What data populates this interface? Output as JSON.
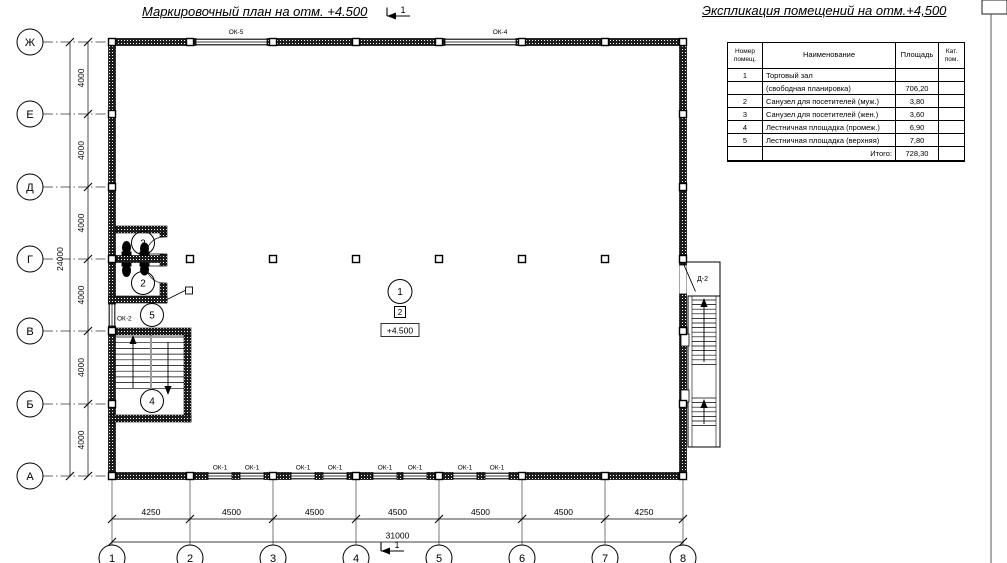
{
  "titles": {
    "plan": "Маркировочный план на отм. +4.500",
    "explication": "Экспликация помещений на отм.+4,500"
  },
  "section_mark": {
    "top": "1",
    "bottom": "1"
  },
  "table": {
    "headers": {
      "num": "Номер помещ.",
      "name": "Наименование",
      "area": "Площадь",
      "cat": "Кат. пом."
    },
    "rows": [
      {
        "num": "1",
        "name": "Торговый зал",
        "area": "",
        "cat": ""
      },
      {
        "num": "",
        "name": "(свободная планировка)",
        "area": "706,20",
        "cat": ""
      },
      {
        "num": "2",
        "name": "Санузел для посетителей (муж.)",
        "area": "3,80",
        "cat": ""
      },
      {
        "num": "3",
        "name": "Санузел для посетителей (жен.)",
        "area": "3,60",
        "cat": ""
      },
      {
        "num": "4",
        "name": "Лестничная площадка (промеж.)",
        "area": "6,90",
        "cat": ""
      },
      {
        "num": "5",
        "name": "Лестничная площадка (верхняя)",
        "area": "7,80",
        "cat": ""
      },
      {
        "num": "",
        "name": "Итого:",
        "area": "728,30",
        "cat": ""
      }
    ]
  },
  "axes": {
    "rows": [
      "Ж",
      "Е",
      "Д",
      "Г",
      "В",
      "Б",
      "А"
    ],
    "cols": [
      "1",
      "2",
      "3",
      "4",
      "5",
      "6",
      "7",
      "8"
    ]
  },
  "dimensions": {
    "left_segments": [
      "4000",
      "4000",
      "4000",
      "4000",
      "4000",
      "4000"
    ],
    "left_total": "24000",
    "bottom_segments": [
      "4250",
      "4500",
      "4500",
      "4500",
      "4500",
      "4500",
      "4250"
    ],
    "bottom_total": "31000"
  },
  "labels": {
    "ok5": "ОК-5",
    "ok4": "ОК-4",
    "ok2": "ОК-2",
    "d2": "Д-2",
    "ok1": [
      "ОК-1",
      "ОК-1",
      "ОК-1",
      "ОК-1",
      "ОК-1",
      "ОК-1",
      "ОК-1",
      "ОК-1"
    ],
    "zone": "2",
    "elevation": "+4.500"
  },
  "rooms": {
    "hall": "1",
    "wc_men": "2",
    "wc_women": "3",
    "landing_mid": "4",
    "landing_top": "5"
  }
}
